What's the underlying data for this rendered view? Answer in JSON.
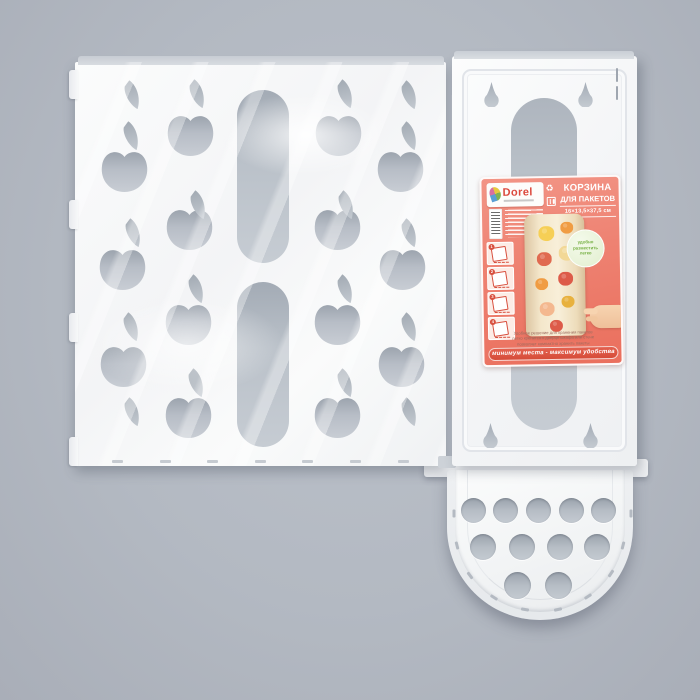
{
  "photo": {
    "subject": "Корзина для пакетов — flat-packed white plastic bag basket with apple-shaped cutouts",
    "background_color": "#b3b9c2",
    "plastic_color": "#f4f5f7",
    "cutout_color": "#b7bdc6"
  },
  "label": {
    "brand": "Dorel",
    "title_line1": "КОРЗИНА",
    "title_line2": "ДЛЯ ПАКЕТОВ",
    "dimensions": "16×13,5×37,5 см",
    "badge_lines": [
      "удобно",
      "разместить",
      "легко"
    ],
    "description_lines": [
      "Удобное решение для хранения пакетов",
      "легко крепится к дверце шкафа или стене",
      "позволяет компактно хранить пакеты"
    ],
    "banner": "минимум места - максимум удобства",
    "steps": [
      "1",
      "2",
      "3",
      "4"
    ],
    "fineprint_line_count": 7,
    "icons": [
      "brand-leaf-icon",
      "recycle-icon",
      "food-safe-icon"
    ],
    "colors": {
      "label_red": "#ee8272",
      "banner_red": "#d64c39",
      "brand_red": "#dc4a3e",
      "badge_green_bg": "#e2efcf",
      "badge_green_text": "#76b043",
      "basket_beige": "#f4e7cb"
    }
  },
  "front_panel": {
    "apples": [
      [
        101,
        150
      ],
      [
        99,
        248
      ],
      [
        100,
        345
      ],
      [
        167,
        114
      ],
      [
        166,
        208
      ],
      [
        165,
        303
      ],
      [
        165,
        396
      ],
      [
        315,
        114
      ],
      [
        314,
        208
      ],
      [
        314,
        303
      ],
      [
        314,
        396
      ],
      [
        377,
        150
      ],
      [
        379,
        248
      ],
      [
        378,
        345
      ]
    ],
    "leaves": [
      [
        124,
        80
      ],
      [
        123,
        121
      ],
      [
        125,
        218
      ],
      [
        123,
        312
      ],
      [
        124,
        397
      ],
      [
        189,
        79
      ],
      [
        190,
        190
      ],
      [
        188,
        274
      ],
      [
        188,
        368
      ],
      [
        337,
        79
      ],
      [
        338,
        190
      ],
      [
        337,
        274
      ],
      [
        337,
        368
      ],
      [
        401,
        80
      ],
      [
        401,
        121
      ],
      [
        401,
        218
      ],
      [
        401,
        312
      ],
      [
        401,
        397
      ]
    ],
    "slots": [
      [
        237,
        90,
        52,
        173
      ],
      [
        237,
        282,
        52,
        165
      ]
    ],
    "edge_tabs": [
      [
        69,
        70
      ],
      [
        69,
        200
      ],
      [
        69,
        313
      ],
      [
        69,
        437
      ]
    ],
    "bottom_marks_x": [
      112,
      160,
      207,
      255,
      302,
      350,
      398
    ],
    "bottom_marks_y": 460
  },
  "hinge": {
    "segments": [
      [
        451,
        95,
        113
      ],
      [
        451,
        240,
        72
      ],
      [
        451,
        318,
        122
      ]
    ]
  },
  "back_panel": {
    "keyholes": [
      [
        484,
        82
      ],
      [
        578,
        82
      ],
      [
        483,
        423
      ],
      [
        583,
        423
      ]
    ],
    "groove_dashes": [
      [
        616,
        68
      ],
      [
        616,
        86
      ]
    ]
  },
  "tray": {
    "holes": [
      [
        473,
        510,
        12.5
      ],
      [
        505,
        510,
        12.5
      ],
      [
        538,
        510,
        12.5
      ],
      [
        571,
        510,
        12.5
      ],
      [
        603,
        510,
        12.5
      ],
      [
        483,
        547,
        13
      ],
      [
        522,
        547,
        13
      ],
      [
        560,
        547,
        13
      ],
      [
        597,
        547,
        13
      ],
      [
        517,
        585,
        13.5
      ],
      [
        558,
        585,
        13.5
      ]
    ],
    "rim_angles": [
      166,
      144,
      122,
      100,
      78,
      56,
      34,
      14
    ],
    "rim_side_marks": [
      [
        450,
        512
      ],
      [
        627,
        512
      ]
    ]
  },
  "basket_holes": [
    {
      "x": 14,
      "y": 12,
      "d": 16,
      "c": "#f6cf56"
    },
    {
      "x": 36,
      "y": 8,
      "d": 13,
      "c": "#f09c43"
    },
    {
      "x": 12,
      "y": 38,
      "d": 15,
      "c": "#e06a50"
    },
    {
      "x": 34,
      "y": 32,
      "d": 16,
      "c": "#f2d896"
    },
    {
      "x": 10,
      "y": 64,
      "d": 13,
      "c": "#f09c43"
    },
    {
      "x": 33,
      "y": 58,
      "d": 15,
      "c": "#dd5b49"
    },
    {
      "x": 14,
      "y": 88,
      "d": 15,
      "c": "#f4b88f"
    },
    {
      "x": 36,
      "y": 82,
      "d": 13,
      "c": "#e8b13e"
    },
    {
      "x": 24,
      "y": 106,
      "d": 13,
      "c": "#dd5b49"
    }
  ]
}
